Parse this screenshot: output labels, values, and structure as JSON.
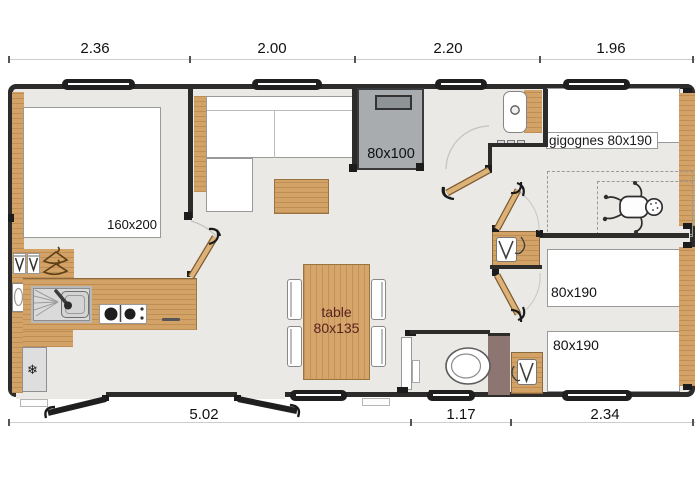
{
  "floorplan": {
    "title": "mobile-home floor plan",
    "dimensions": {
      "top": [
        "2.36",
        "2.00",
        "2.20",
        "1.96"
      ],
      "bottom": [
        "5.02",
        "1.17",
        "2.34"
      ]
    },
    "labels": {
      "master_bed": "160x200",
      "shower": "80x100",
      "gigognes_bed": "gigognes 80x190",
      "single_bed_top": "80x190",
      "single_bed_bottom": "80x190",
      "table": [
        "table",
        "80x135"
      ]
    },
    "icons": {
      "fridge_snowflake": "❄"
    },
    "colors": {
      "wall": "#2e2c2a",
      "floor": "#eae9e6",
      "wood": "#d2a267",
      "shower_gray": "#a8acaf",
      "wc_partition": "#8d7571",
      "table_text": "#56241c"
    }
  }
}
